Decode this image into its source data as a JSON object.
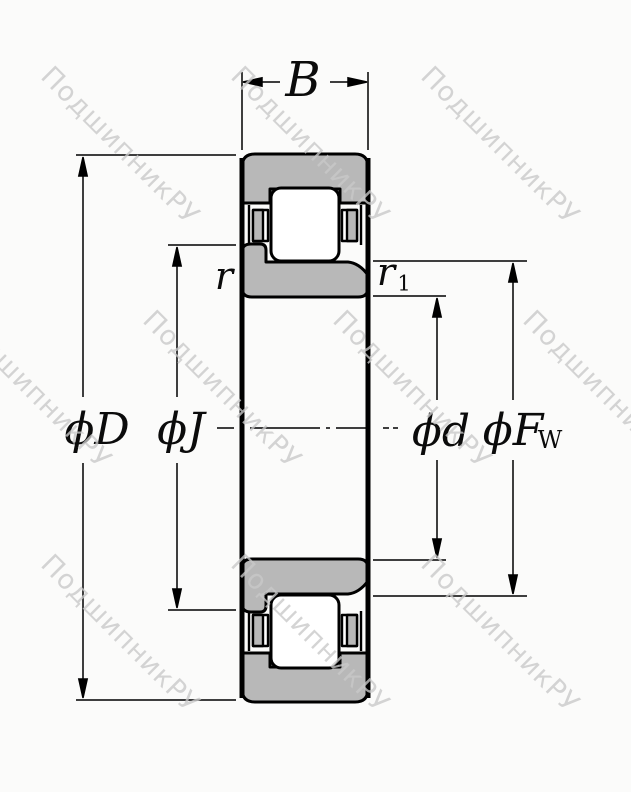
{
  "diagram": {
    "type": "cylindrical-roller-bearing-cross-section",
    "labels": {
      "width": "B",
      "outer_diameter": "ϕD",
      "flange_diameter": "ϕJ",
      "bore_diameter": "ϕd",
      "raceway_diameter": "ϕF",
      "raceway_diameter_sub": "W",
      "chamfer_outer": "r",
      "chamfer_inner": "r",
      "chamfer_inner_sub": "1"
    },
    "colors": {
      "ring_fill": "#b8b8b8",
      "outline": "#000000",
      "background": "#fbfbfa",
      "watermark": "#c9c9c9"
    }
  },
  "watermark": {
    "text": "ПодшипникРУ"
  }
}
